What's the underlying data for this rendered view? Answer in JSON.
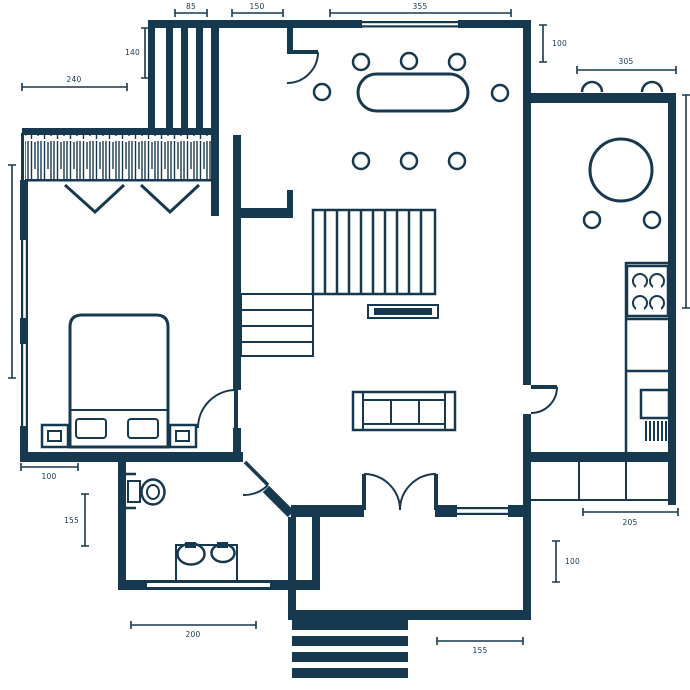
{
  "meta": {
    "drawing_type": "architectural floor plan",
    "units_shown": "numeric dimension labels only"
  },
  "colors": {
    "ink": "#17394F",
    "background": "#FFFFFF"
  },
  "dimensions": {
    "d85": "85",
    "d150": "150",
    "d355": "355",
    "d140": "140",
    "d240": "240",
    "d100_top_right": "100",
    "d305": "305",
    "d100_bedroom": "100",
    "d155_bathroom": "155",
    "d200_bathroom": "200",
    "d155_porch": "155",
    "d205_kitchen": "205",
    "d100_porch": "100"
  },
  "icons": [
    "wardrobe-hatch",
    "hanger-rod-v",
    "bed",
    "pillow",
    "nightstand",
    "toilet",
    "double-sink-vanity",
    "staircase-upper",
    "staircase-lower",
    "tv-console",
    "sofa",
    "dining-table",
    "dining-chair",
    "round-table",
    "stove-burners",
    "kitchen-sink",
    "kitchen-counter",
    "rear-deck",
    "entry-double-door",
    "porch-steps",
    "door-swing",
    "window"
  ]
}
